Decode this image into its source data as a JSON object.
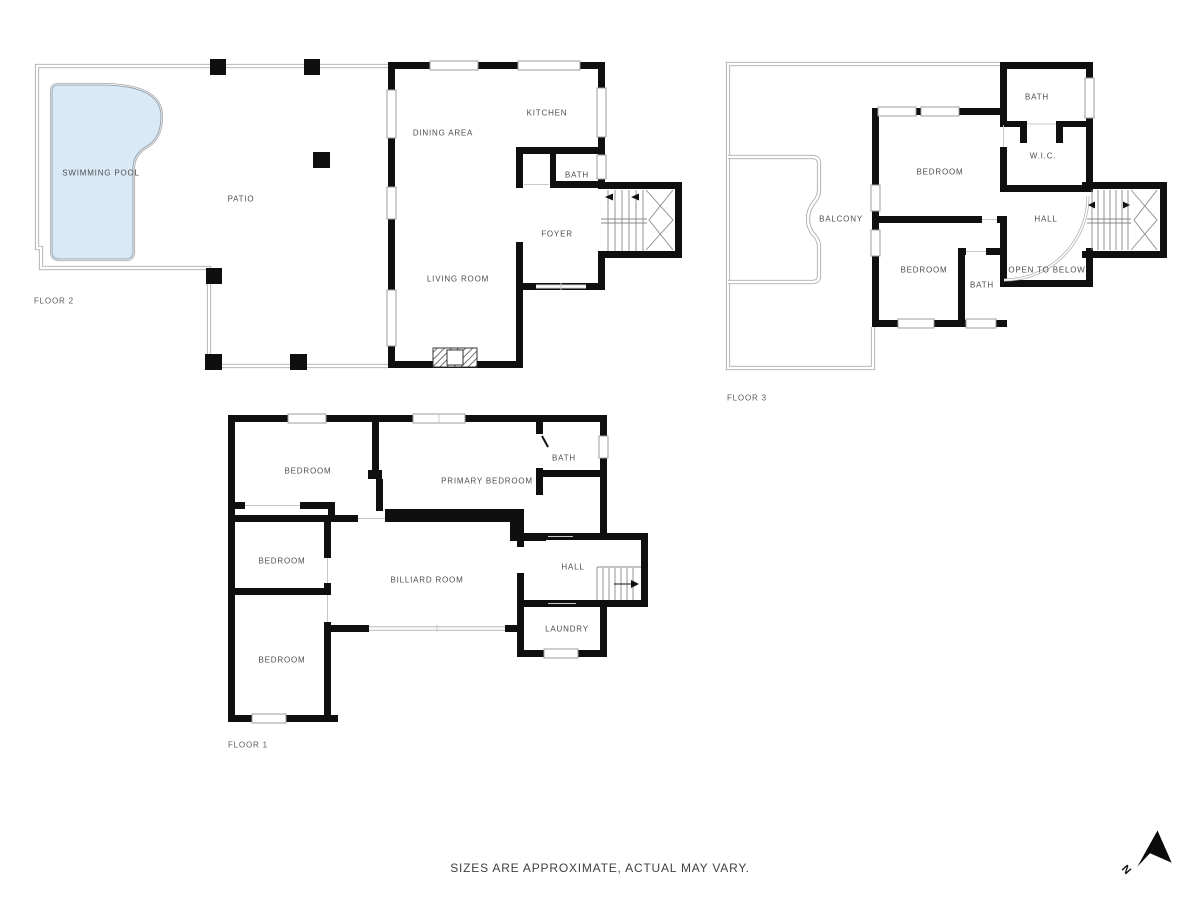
{
  "disclaimer": "SIZES ARE APPROXIMATE, ACTUAL MAY VARY.",
  "compass": {
    "north_label": "N"
  },
  "colors": {
    "wall": "#0f0f0f",
    "thin_line": "#a9a9a9",
    "pool_fill": "#d9eaf6",
    "pool_edge": "#9aa7b3",
    "label_text": "#4d4d4d"
  },
  "floors": {
    "floor2": {
      "name": "FLOOR 2",
      "rooms": {
        "swimming_pool": "SWIMMING POOL",
        "patio": "PATIO",
        "dining_area": "DINING AREA",
        "kitchen": "KITCHEN",
        "bath": "BATH",
        "foyer": "FOYER",
        "living_room": "LIVING ROOM"
      }
    },
    "floor3": {
      "name": "FLOOR 3",
      "rooms": {
        "bath_top": "BATH",
        "wic": "W.I.C.",
        "bedroom_top": "BEDROOM",
        "balcony": "BALCONY",
        "hall": "HALL",
        "bedroom_bottom": "BEDROOM",
        "bath_bottom": "BATH",
        "open_to_below": "OPEN TO BELOW"
      }
    },
    "floor1": {
      "name": "FLOOR 1",
      "rooms": {
        "bedroom_top": "BEDROOM",
        "primary_bedroom": "PRIMARY BEDROOM",
        "bath": "BATH",
        "bedroom_mid": "BEDROOM",
        "billiard_room": "BILLIARD ROOM",
        "hall": "HALL",
        "bedroom_bottom": "BEDROOM",
        "laundry": "LAUNDRY"
      }
    }
  }
}
